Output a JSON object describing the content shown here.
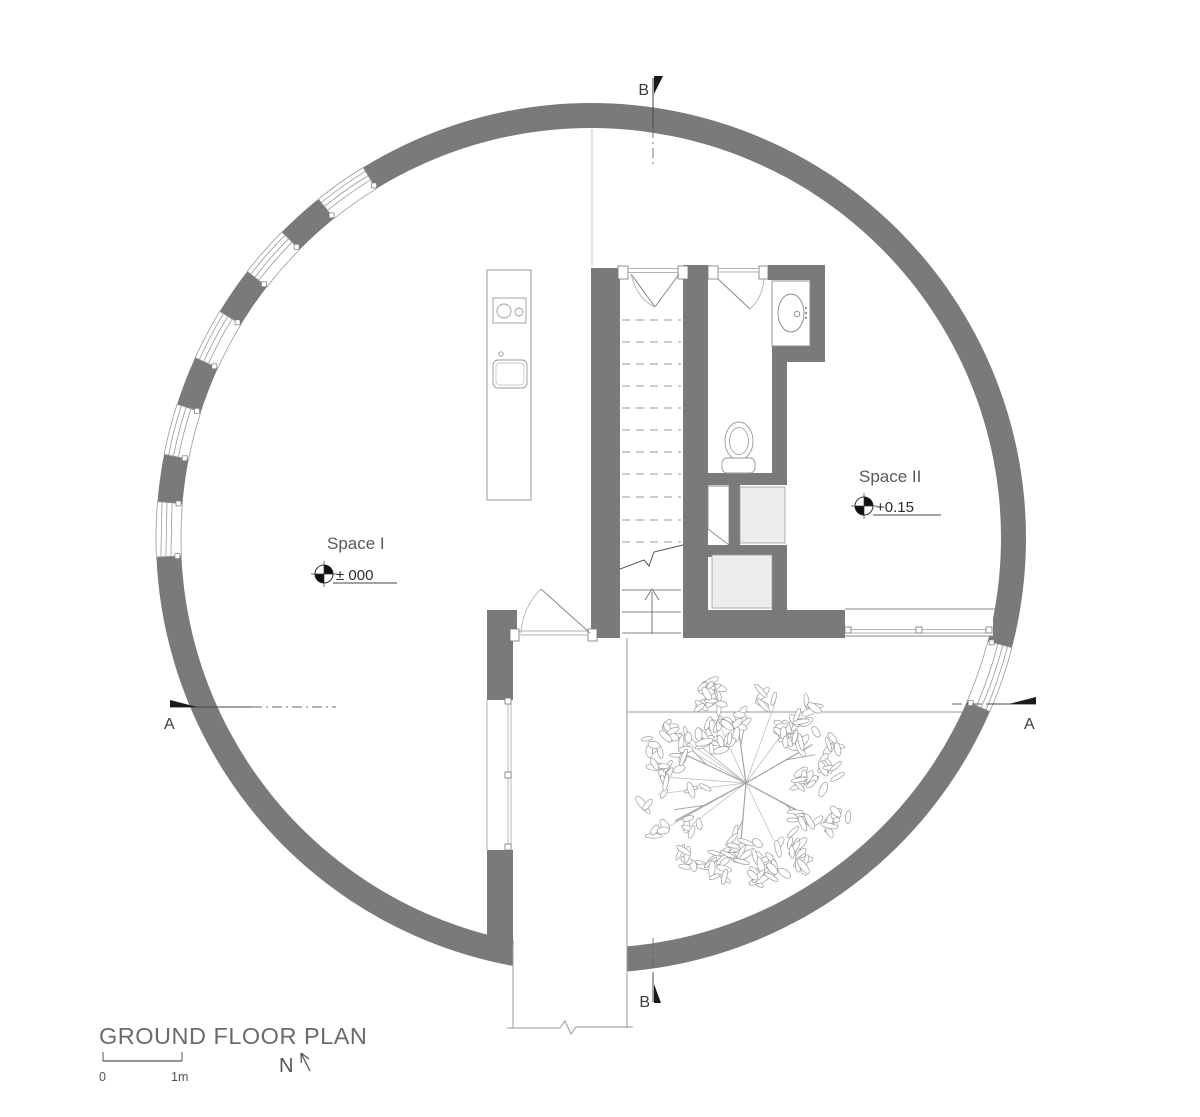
{
  "drawing": {
    "title": "GROUND FLOOR PLAN",
    "north_label": "N",
    "scale": {
      "zero": "0",
      "one_meter": "1m"
    }
  },
  "rooms": [
    {
      "name": "Space I",
      "level": "± 000"
    },
    {
      "name": "Space II",
      "level": "+0.15"
    }
  ],
  "sections": {
    "a": "A",
    "b": "B"
  },
  "colors": {
    "wall": "#7a7a7a",
    "thin_line": "#999999",
    "closet_fill": "#ededed",
    "marker_black": "#1a1a1a",
    "text_gray": "#5a5a5a",
    "title_gray": "#6b6b6b"
  }
}
